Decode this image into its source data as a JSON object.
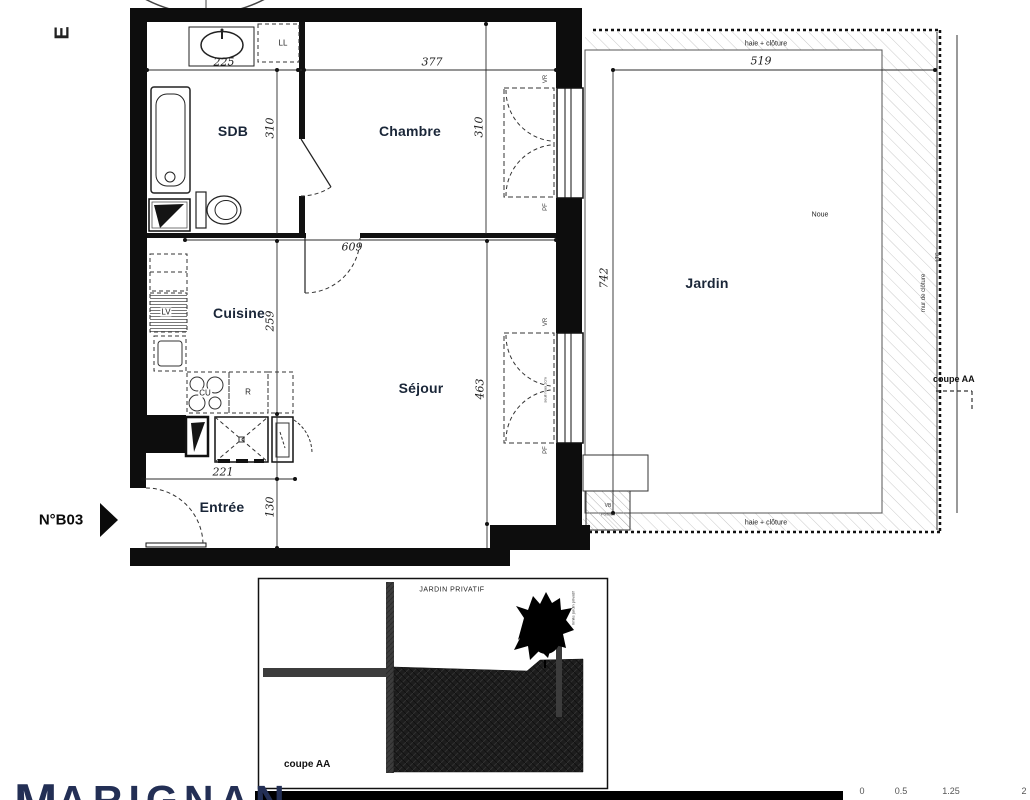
{
  "plan": {
    "compass": "E",
    "unit": "N°B03",
    "rooms": {
      "sdb": "SDB",
      "chambre": "Chambre",
      "cuisine": "Cuisine",
      "sejour": "Séjour",
      "entree": "Entrée",
      "jardin": "Jardin"
    },
    "dims": {
      "sink": "225",
      "chambre_w": "377",
      "sdb_h": "310",
      "chambre_h": "310",
      "sejour_w": "609",
      "cuisine_h": "259",
      "sejour_h": "463",
      "kitchen_w": "221",
      "entree_h": "130",
      "jardin_w": "519",
      "jardin_h": "742"
    },
    "equip": {
      "washing_machine": "LL",
      "dishwasher": "LV",
      "cooktop": "CU",
      "fridge": "R",
      "vb": "VB",
      "vb_sub": "Portillon"
    },
    "win": {
      "vr": "VR",
      "pf": "PF",
      "seuil": "seuil max 2cm"
    },
    "garden": {
      "haie": "haie + clôture",
      "noue": "Noue",
      "mur": "mur de clôture",
      "ltc": "LTC",
      "coupe": "coupe AA"
    },
    "section": {
      "title": "coupe AA",
      "garden_label": "JARDIN PRIVATIF",
      "limit_label": "limite jardin privatif"
    },
    "logo": {
      "m": "M",
      "rest": "ARIGNAN"
    },
    "scale": [
      "0",
      "0.5",
      "1.25",
      "2"
    ]
  }
}
